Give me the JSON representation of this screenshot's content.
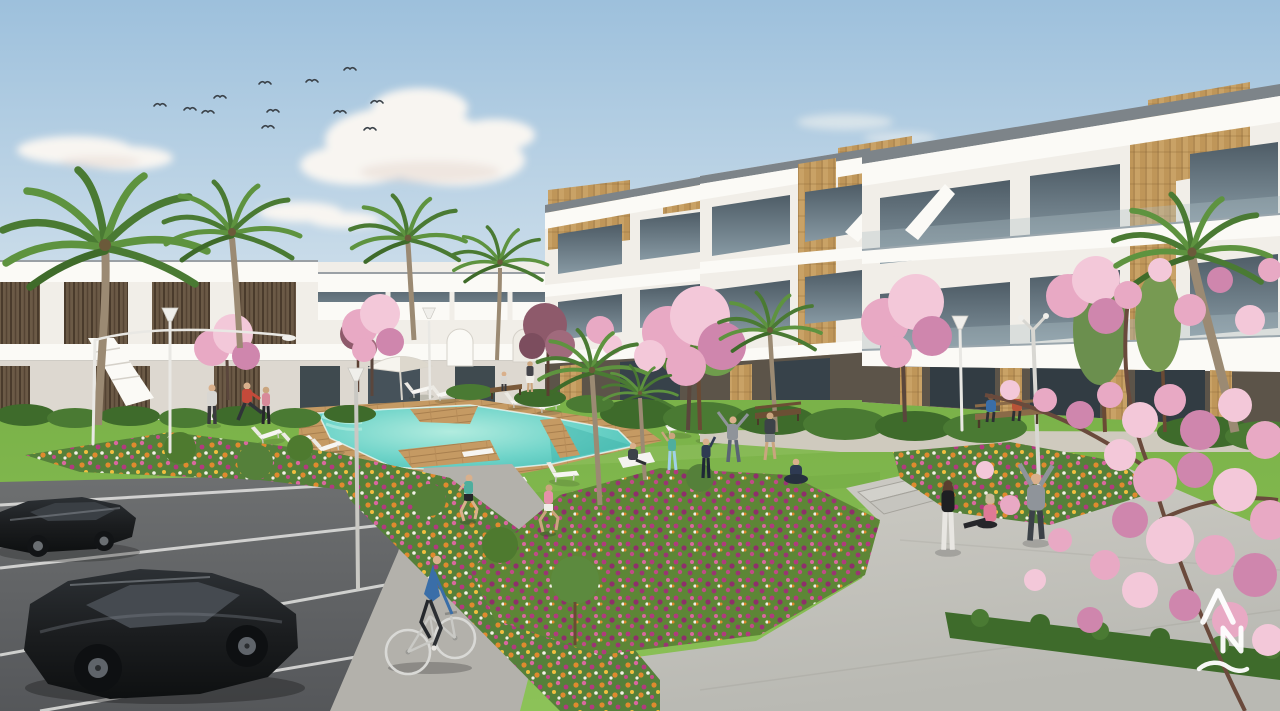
{
  "scene": {
    "description": "Sunny 3D architectural render of a new-build residential complex: white apartment blocks with wood accents around a communal garden with turquoise pool, lawns, flower beds, palm and blossom trees, a paved plaza and a parking area with black cars, joggers and a cyclist.",
    "watermark": {
      "monogram": "AN",
      "color": "#ffffff"
    }
  },
  "elements": {
    "sky": "Clear morning sky",
    "clouds": "Soft cumulus clouds",
    "birds": "Flock of birds",
    "apartments_right": "Three-storey white apartment blocks with timber cladding and glass balconies",
    "terraces_left": "Two-storey terraced homes with dark timber slats",
    "palms": "Palm trees",
    "blossom_trees": "Pink blossom trees",
    "pool": "Turquoise swimming pool with timber deck",
    "loungers": "White sun loungers",
    "parasol": "White garden parasol",
    "lawn": "Communal lawn",
    "flower_beds": "Mixed orange and magenta flower beds",
    "plaza": "Paved plaza with steps",
    "sidewalk": "Pedestrian path",
    "parking": "Parking bays",
    "cars": "Two black parked cars",
    "cyclist": "Cyclist on the path",
    "joggers": "Two joggers",
    "residents": "Residents exercising on the lawn",
    "benches": "Garden benches",
    "street_lamps": "Modern street lamps",
    "watermark": "Developer monogram watermark"
  },
  "palette": {
    "sky-top": "#9dc0dc",
    "sky-mid": "#c8dbe9",
    "sky-horizon": "#ebe7e2",
    "cloud": "#f8f5f1",
    "cloud-shade": "#e8d8d1",
    "bird": "#3a4148",
    "building-white": "#f1eee8",
    "building-bright": "#fbfaf6",
    "building-shade": "#ddd8d0",
    "roof-cap": "#7d8489",
    "glass-dark": "#4e5c66",
    "glass-light": "#8799a3",
    "wood-light": "#c9a266",
    "wood-line": "#9a7440",
    "wood-dark": "#6b5a46",
    "palm-green": "#4a7a33",
    "palm-green-2": "#5e933f",
    "palm-trunk": "#9b8a73",
    "grass-light": "#8cc258",
    "grass-dark": "#79b148",
    "hedge": "#3e6b2b",
    "pool-water": "#6fd4c9",
    "pool-light": "#b2ecdf",
    "pool-deep": "#46bcb2",
    "deck-wood": "#c59a63",
    "plaza-gray": "#c8c7c1",
    "sidewalk-gray": "#b3b1ab",
    "asphalt": "#6e7071",
    "asphalt-dark": "#55575a",
    "parking-line": "#e3e3e1",
    "blossom-pink": "#e8a9c4",
    "blossom-light": "#f3c8d9",
    "blossom-deep": "#cf86ad",
    "flower-orange": "#e08a2e",
    "flower-magenta": "#b13a7e",
    "flower-pink": "#d9689f",
    "flower-white": "#f2efe6",
    "car-black": "#1b1d1f",
    "lamp-pole": "#e9e8e4",
    "watermark-white": "#ffffff"
  }
}
